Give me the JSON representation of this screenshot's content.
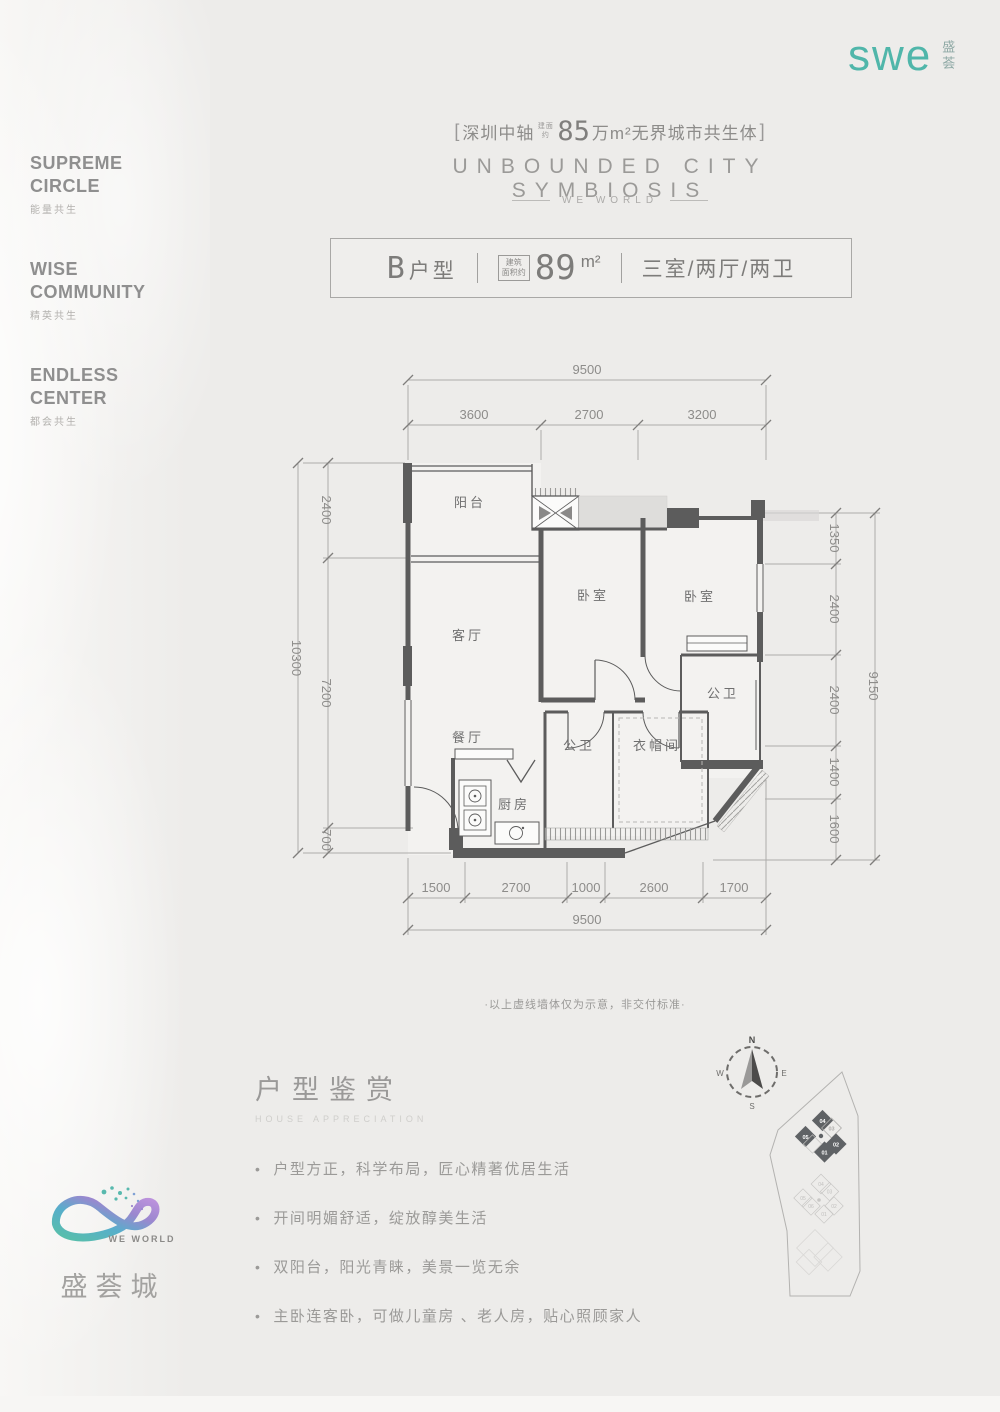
{
  "brand": {
    "logo_text": "swe",
    "logo_cn": "盛荟",
    "accent_color": "#50b6aa"
  },
  "left_rail": {
    "items": [
      {
        "en": "SUPREME\nCIRCLE",
        "cn": "能量共生"
      },
      {
        "en": "WISE\nCOMMUNITY",
        "cn": "精英共生"
      },
      {
        "en": "ENDLESS\nCENTER",
        "cn": "都会共生"
      }
    ]
  },
  "header": {
    "bracket_left": "[",
    "city": "深圳中轴",
    "area_prefix": "建面约",
    "big_number": "85",
    "rest": "万m²无界城市共生体",
    "bracket_right": "]",
    "title_en": "UNBOUNDED CITY SYMBIOSIS",
    "subtitle": "WE WORLD"
  },
  "unit_bar": {
    "unit_code": "B",
    "unit_suffix": "户型",
    "area_label_1": "建筑",
    "area_label_2": "面积约",
    "area_value": "89",
    "area_unit": "m²",
    "layout": "三室/两厅/两卫"
  },
  "floorplan": {
    "rooms": [
      "阳台",
      "客厅",
      "卧室",
      "卧室",
      "公卫",
      "公卫",
      "衣帽间",
      "餐厅",
      "厨房"
    ],
    "dims": {
      "top_total": "9500",
      "top_segments": [
        "3600",
        "2700",
        "3200"
      ],
      "left_outer": "10300",
      "left_segments": [
        "2400",
        "7200",
        "700"
      ],
      "right_outer": "9150",
      "right_segments": [
        "1350",
        "2400",
        "2400",
        "1400",
        "1600"
      ],
      "bottom_segments": [
        "1500",
        "2700",
        "1000",
        "2600",
        "1700"
      ],
      "bottom_total": "9500"
    },
    "note": "·以上虚线墙体仅为示意，非交付标准·"
  },
  "appreciation": {
    "title": "户型鉴赏",
    "subtitle": "HOUSE APPRECIATION",
    "bullet_glyph": "•",
    "bullets": [
      "户型方正，科学布局，匠心精著优居生活",
      "开间明媚舒适，绽放醇美生活",
      "双阳台，阳光青睐，美景一览无余",
      "主卧连客卧，可做儿童房 、老人房，贴心照顾家人"
    ]
  },
  "siteplan": {
    "compass": {
      "n": "N",
      "e": "E",
      "s": "S",
      "w": "W"
    },
    "dark_buildings": [
      "04",
      "03",
      "05",
      "02",
      "01"
    ],
    "light_buildings": [
      "04",
      "03",
      "05",
      "06",
      "02",
      "01"
    ]
  },
  "footer": {
    "we_world": "WE WORLD",
    "name": "盛荟城"
  }
}
